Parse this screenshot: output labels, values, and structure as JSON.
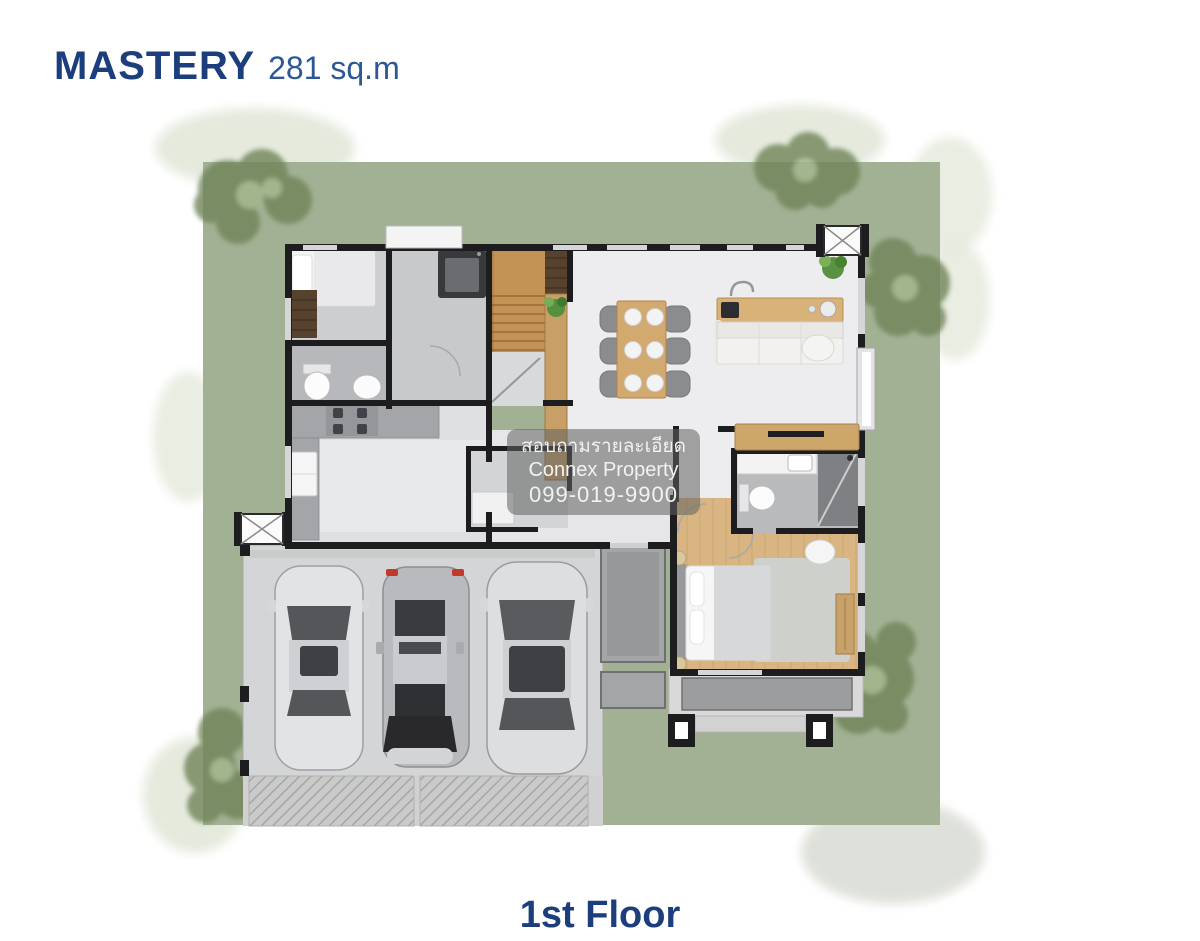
{
  "header": {
    "plan_name": "MASTERY",
    "area": "281 sq.m"
  },
  "watermark": {
    "line1": "สอบถามรายละเอียด",
    "line2": "Connex Property",
    "line3": "099-019-9900"
  },
  "footer": {
    "floor_label": "1st Floor"
  },
  "palette": {
    "title_navy": "#1d3e7c",
    "area_blue": "#2d5795",
    "lawn_green": "#a2b194",
    "tree_green": "#6f8458",
    "wall_dark": "#1d1d1f",
    "wood_tan": "#cfa368",
    "bedroom_wood": "#d8b582",
    "floor_grey": "#ecedef",
    "watermark_bg": "rgba(96,96,96,0.55)",
    "watermark_text": "#f2f2f2"
  }
}
